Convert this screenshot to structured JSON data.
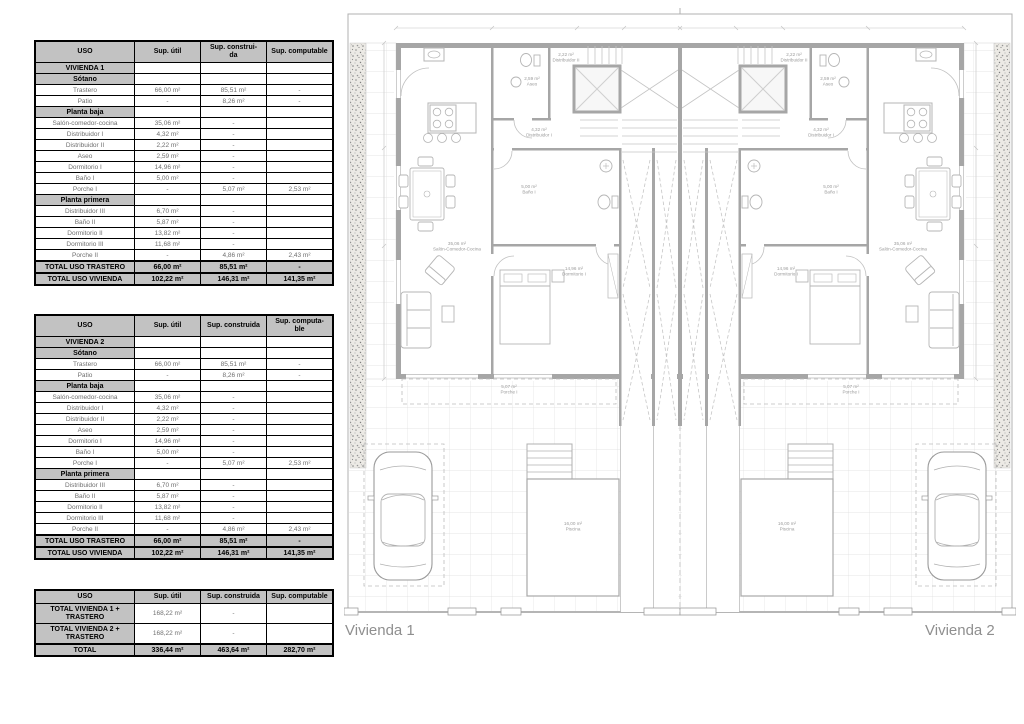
{
  "tables": [
    {
      "header": [
        "USO",
        "Sup. útil",
        "Sup. construi-\nda",
        "Sup. computable"
      ],
      "rows": [
        {
          "type": "section",
          "cells": [
            "VIVIENDA 1",
            "",
            "",
            ""
          ]
        },
        {
          "type": "section",
          "cells": [
            "Sótano",
            "",
            "",
            ""
          ]
        },
        {
          "type": "data",
          "cells": [
            "Trastero",
            "66,00 m²",
            "85,51 m²",
            "-"
          ]
        },
        {
          "type": "data",
          "cells": [
            "Patio",
            "-",
            "8,26 m²",
            "-"
          ]
        },
        {
          "type": "section",
          "cells": [
            "Planta baja",
            "",
            "",
            ""
          ]
        },
        {
          "type": "data",
          "cells": [
            "Salón-comedor-cocina",
            "35,06 m²",
            "-",
            ""
          ]
        },
        {
          "type": "data",
          "cells": [
            "Distribuidor I",
            "4,32 m²",
            "-",
            ""
          ]
        },
        {
          "type": "data",
          "cells": [
            "Distribuidor II",
            "2,22 m²",
            "-",
            ""
          ]
        },
        {
          "type": "data",
          "cells": [
            "Aseo",
            "2,59 m²",
            "-",
            ""
          ]
        },
        {
          "type": "data",
          "cells": [
            "Dormitorio I",
            "14,96 m²",
            "-",
            ""
          ]
        },
        {
          "type": "data",
          "cells": [
            "Baño I",
            "5,00 m²",
            "-",
            ""
          ]
        },
        {
          "type": "data",
          "cells": [
            "Porche I",
            "-",
            "5,07 m²",
            "2,53 m²"
          ]
        },
        {
          "type": "section",
          "cells": [
            "Planta primera",
            "",
            "",
            ""
          ]
        },
        {
          "type": "data",
          "cells": [
            "Distribuidor III",
            "6,70 m²",
            "-",
            ""
          ]
        },
        {
          "type": "data",
          "cells": [
            "Baño II",
            "5,87 m²",
            "-",
            ""
          ]
        },
        {
          "type": "data",
          "cells": [
            "Dormitorio II",
            "13,82 m²",
            "-",
            ""
          ]
        },
        {
          "type": "data",
          "cells": [
            "Dormitorio III",
            "11,68 m²",
            "-",
            ""
          ]
        },
        {
          "type": "data",
          "cells": [
            "Porche II",
            "-",
            "4,86 m²",
            "2,43 m²"
          ]
        },
        {
          "type": "total",
          "cells": [
            "TOTAL USO TRASTERO",
            "66,00 m²",
            "85,51 m²",
            "-"
          ]
        },
        {
          "type": "total",
          "cells": [
            "TOTAL USO VIVIENDA",
            "102,22 m²",
            "146,31 m²",
            "141,35 m²"
          ]
        }
      ]
    },
    {
      "header": [
        "USO",
        "Sup. útil",
        "Sup. construida",
        "Sup. computa-\nble"
      ],
      "rows": [
        {
          "type": "section",
          "cells": [
            "VIVIENDA 2",
            "",
            "",
            ""
          ]
        },
        {
          "type": "section",
          "cells": [
            "Sótano",
            "",
            "",
            ""
          ]
        },
        {
          "type": "data",
          "cells": [
            "Trastero",
            "66,00 m²",
            "85,51 m²",
            "-"
          ]
        },
        {
          "type": "data",
          "cells": [
            "Patio",
            "-",
            "8,26 m²",
            "-"
          ]
        },
        {
          "type": "section",
          "cells": [
            "Planta baja",
            "",
            "",
            ""
          ]
        },
        {
          "type": "data",
          "cells": [
            "Salón-comedor-cocina",
            "35,06 m²",
            "-",
            ""
          ]
        },
        {
          "type": "data",
          "cells": [
            "Distribuidor I",
            "4,32 m²",
            "-",
            ""
          ]
        },
        {
          "type": "data",
          "cells": [
            "Distribuidor II",
            "2,22 m²",
            "-",
            ""
          ]
        },
        {
          "type": "data",
          "cells": [
            "Aseo",
            "2,59 m²",
            "-",
            ""
          ]
        },
        {
          "type": "data",
          "cells": [
            "Dormitorio I",
            "14,96 m²",
            "-",
            ""
          ]
        },
        {
          "type": "data",
          "cells": [
            "Baño I",
            "5,00 m²",
            "-",
            ""
          ]
        },
        {
          "type": "data",
          "cells": [
            "Porche I",
            "-",
            "5,07 m²",
            "2,53 m²"
          ]
        },
        {
          "type": "section",
          "cells": [
            "Planta primera",
            "",
            "",
            ""
          ]
        },
        {
          "type": "data",
          "cells": [
            "Distribuidor III",
            "6,70 m²",
            "-",
            ""
          ]
        },
        {
          "type": "data",
          "cells": [
            "Baño II",
            "5,87 m²",
            "-",
            ""
          ]
        },
        {
          "type": "data",
          "cells": [
            "Dormitorio II",
            "13,82 m²",
            "-",
            ""
          ]
        },
        {
          "type": "data",
          "cells": [
            "Dormitorio III",
            "11,68 m²",
            "-",
            ""
          ]
        },
        {
          "type": "data",
          "cells": [
            "Porche II",
            "-",
            "4,86 m²",
            "2,43 m²"
          ]
        },
        {
          "type": "total",
          "cells": [
            "TOTAL USO TRASTERO",
            "66,00 m²",
            "85,51 m²",
            "-"
          ]
        },
        {
          "type": "total",
          "cells": [
            "TOTAL USO VIVIENDA",
            "102,22 m²",
            "146,31 m²",
            "141,35 m²"
          ]
        }
      ]
    },
    {
      "header": [
        "USO",
        "Sup. útil",
        "Sup. construida",
        "Sup. computable"
      ],
      "rows": [
        {
          "type": "summary",
          "cells": [
            "TOTAL VIVIENDA 1 +\nTRASTERO",
            "168,22 m²",
            "-",
            ""
          ]
        },
        {
          "type": "summary",
          "cells": [
            "TOTAL VIVIENDA 2 +\nTRASTERO",
            "168,22 m²",
            "-",
            ""
          ]
        },
        {
          "type": "total",
          "cells": [
            "TOTAL",
            "336,44 m²",
            "463,64 m²",
            "282,70 m²"
          ]
        }
      ]
    }
  ],
  "plan": {
    "unit_left_label": "Vivienda 1",
    "unit_right_label": "Vivienda 2",
    "rooms": {
      "aseo": {
        "area": "2,59 m²",
        "name": "Aseo"
      },
      "distribuidor2": {
        "area": "2,22 m²",
        "name": "Distribuidor II"
      },
      "distribuidor1": {
        "area": "4,32 m²",
        "name": "Distribuidor I"
      },
      "salon": {
        "area": "35,06 m²",
        "name": "Salón-Comedor-Cocina"
      },
      "bano1": {
        "area": "5,00 m²",
        "name": "Baño I"
      },
      "dormitorio1": {
        "area": "14,96 m²",
        "name": "Dormitorio I"
      },
      "porche1": {
        "area": "5,07 m²",
        "name": "Porche I"
      },
      "piscina": {
        "area": "16,00 m²",
        "name": "Piscina"
      }
    }
  },
  "colors": {
    "section_bg": "#c2c2c2",
    "table_border": "#000000",
    "data_text": "#6f6f6f",
    "plan_wall": "#a6a6a6",
    "plan_line": "#c2c2c2",
    "plan_label": "#9b9b9b"
  }
}
